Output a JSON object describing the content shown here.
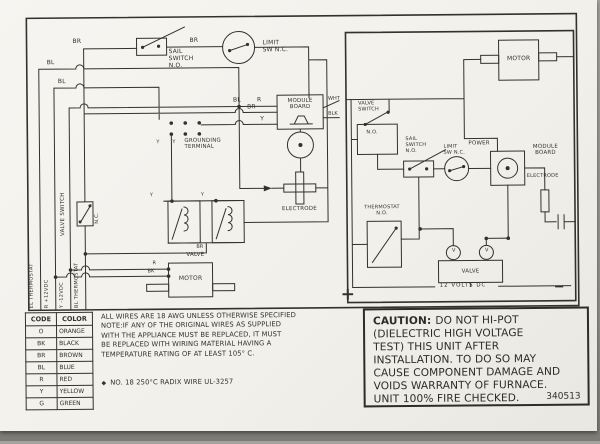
{
  "colors": {
    "ink": "#33312e",
    "paper": "#f4f2ed",
    "background": "#8a8884"
  },
  "left_diagram": {
    "wire_labels": {
      "br1": "BR",
      "br2": "BR",
      "bl1": "BL",
      "bl2": "BL",
      "bl3": "BL",
      "r1": "R",
      "br3": "BR",
      "y1": "Y",
      "gt_y1": "Y",
      "gt_y2": "Y",
      "valve_y1": "Y",
      "valve_y2": "Y",
      "br4": "BR",
      "motor_r": "R",
      "motor_bk": "BK"
    },
    "sail_switch": "SAIL\nSWITCH\nN.O.",
    "limit_switch": "LIMIT\nSW N.C.",
    "module_board": "MODULE\nBOARD",
    "lead_wht": "WHT",
    "lead_blk": "BLK",
    "grounding_terminal": "GROUNDING\nTERMINAL",
    "valve_switch": "VALVE SWITCH",
    "valve_switch_nc": "N.C.",
    "electrode": "ELECTRODE",
    "valve": "VALVE",
    "motor": "MOTOR",
    "bus_el_thermostat": "EL THERMOSTAT",
    "bus_r_12vdc": "R +12VDC",
    "bus_y_12vdc": "Y -12VDC",
    "bus_bl_thermostat": "BL THERMOSTAT"
  },
  "right_diagram": {
    "motor": "MOTOR",
    "valve_switch": "VALVE\nSWITCH",
    "valve_switch_no": "N.O.",
    "sail_switch": "SAIL\nSWITCH\nN.O.",
    "limit_switch": "LIMIT\nSW N.C.",
    "power": "POWER",
    "module_board": "MODULE\nBOARD",
    "electrode": "ELECTRODE",
    "thermostat": "THERMOSTAT\nN.O.",
    "valve": "VALVE",
    "valve_v1": "V",
    "valve_v2": "V",
    "supply": "12 VOLTS DC",
    "plus": "+",
    "minus": "−"
  },
  "wire_table": {
    "headers": [
      "CODE",
      "COLOR"
    ],
    "rows": [
      [
        "O",
        "ORANGE"
      ],
      [
        "BK",
        "BLACK"
      ],
      [
        "BR",
        "BROWN"
      ],
      [
        "BL",
        "BLUE"
      ],
      [
        "R",
        "RED"
      ],
      [
        "Y",
        "YELLOW"
      ],
      [
        "G",
        "GREEN"
      ]
    ]
  },
  "notes": {
    "line1": "ALL WIRES ARE 18 AWG UNLESS OTHERWISE SPECIFIED",
    "body": "NOTE:IF ANY OF THE ORIGINAL WIRES AS SUPPLIED\nWITH THE APPLIANCE MUST BE REPLACED, IT MUST\nBE REPLACED WITH WIRING MATERIAL HAVING A\nTEMPERATURE RATING OF AT LEAST 105° C.",
    "footnote_bullet": "◆",
    "footnote": "NO. 18 250°C RADIX WIRE UL-3257"
  },
  "caution": {
    "title": "CAUTION:",
    "lines": [
      "DO NOT HI-POT",
      "(DIELECTRIC HIGH VOLTAGE",
      "TEST) THIS UNIT AFTER",
      "INSTALLATION. TO DO SO MAY",
      "CAUSE COMPONENT DAMAGE AND",
      "VOIDS WARRANTY OF FURNACE.",
      "UNIT 100% FIRE CHECKED."
    ],
    "part_number": "340513"
  }
}
